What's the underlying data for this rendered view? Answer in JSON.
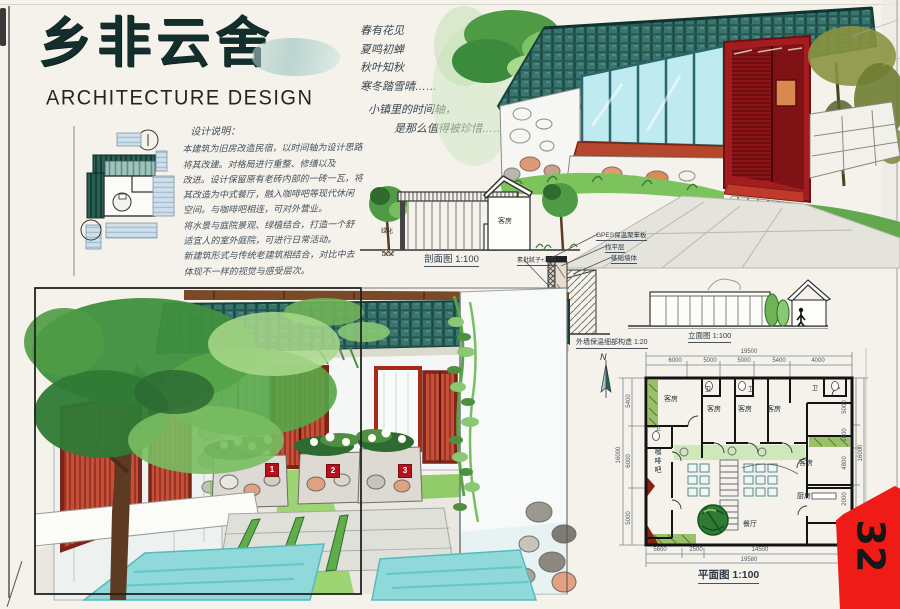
{
  "board": {
    "page_number": "32"
  },
  "title_block": {
    "title": "乡非云舍",
    "subtitle": "ARCHITECTURE DESIGN"
  },
  "poem": {
    "lines": [
      "春有花见",
      "夏鸣初蝉",
      "秋叶知秋",
      "寒冬踏雪晴……",
      "小镇里的时间轴，",
      "是那么值得被珍惜……"
    ]
  },
  "design_notes": {
    "heading": "设计说明：",
    "lines": [
      "本建筑为旧房改造民宿，以时间轴为设计思路",
      "将其改建。对格局进行重整、修缮以及",
      "改进。设计保留原有老砖内部的一砖一瓦，将",
      "其改造为中式餐厅，融入咖啡吧等现代休闲",
      "空间。与咖啡吧相连，可对外营业。",
      "将水景与庭院景观、绿植结合，打造一个舒",
      "适宜人的室外庭院，可进行日常活动。",
      "新建筑形式与传统老建筑相结合，对比中去",
      "体现不一样的视觉与感受层次。"
    ]
  },
  "section_drawing": {
    "room_label": "客房",
    "side_label": "绿化",
    "caption": "剖面图 1:100"
  },
  "wall_detail": {
    "labels": [
      "GPES保温聚苯板",
      "找平层",
      "基础墙体",
      "素批腻子+涂料",
      "保温砂浆"
    ],
    "caption": "外墙保温细部构造 1:20"
  },
  "elevation": {
    "caption": "立面图 1:100"
  },
  "courtyard": {
    "plaques": [
      "1",
      "2",
      "3"
    ]
  },
  "floor_plan": {
    "caption": "平面图 1:100",
    "north_label": "N",
    "room_labels": {
      "guest": "客房",
      "wc": "卫",
      "cafe": "咖啡吧",
      "dining": "餐厅",
      "kitchen": "厨房"
    },
    "dims": {
      "top": [
        "6000",
        "5000",
        "5000",
        "5400",
        "4000"
      ],
      "top_overall": "19500",
      "bottom": [
        "5600",
        "2500",
        "14500"
      ],
      "bottom_overall": "19580",
      "left": [
        "5400",
        "6000",
        "5000"
      ],
      "left_overall": "16000",
      "right": [
        "5000",
        "1800",
        "4800",
        "2000"
      ],
      "right_overall": "16000"
    }
  },
  "colors": {
    "roof_teal": "#39756d",
    "portal_red": "#a31d20",
    "door_red": "#c4503a",
    "water_cyan": "#8fd9da",
    "foliage_green": "#4f9b45",
    "tab_red": "#ee1b17"
  }
}
